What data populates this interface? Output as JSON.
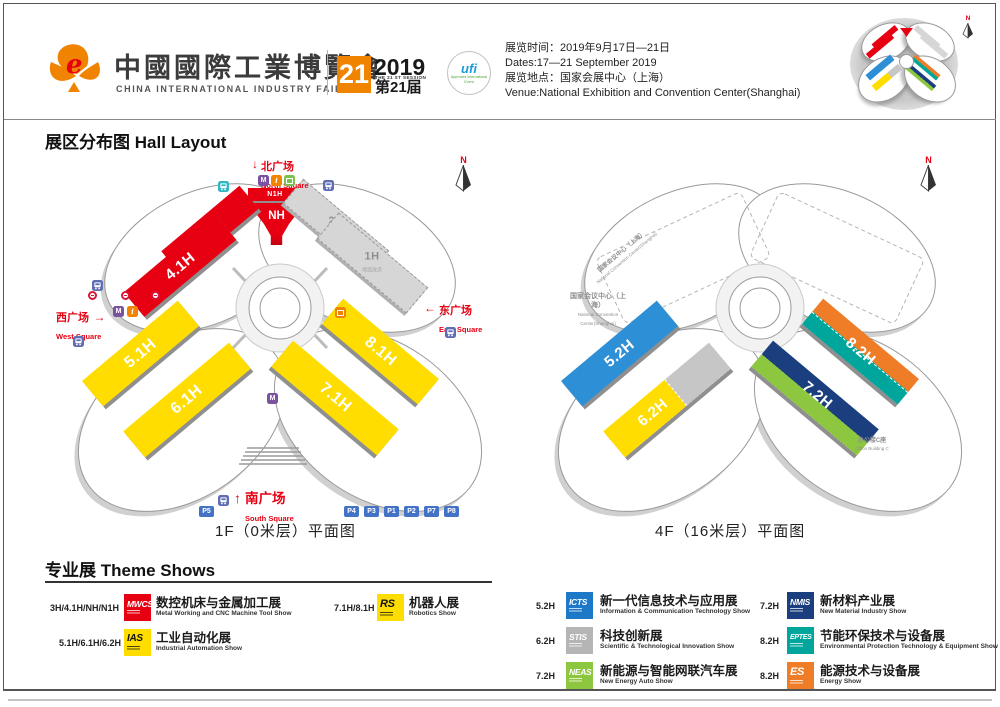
{
  "header": {
    "brand_cn": "中國國際工業博覽會",
    "brand_en": "CHINA INTERNATIONAL INDUSTRY FAIR",
    "badge_number": "21",
    "badge_year": "2019",
    "badge_session_en": "THE 21 ST SESSION",
    "badge_session_cn": "第21届",
    "ufi_name": "ufi",
    "ufi_sub": "Approved International Event",
    "info_lines": [
      "展览时间：2019年9月17日—21日",
      "Dates:17—21 September 2019",
      "展览地点：国家会展中心（上海）",
      "Venue:National Exhibition and Convention Center(Shanghai)"
    ],
    "compass": "N"
  },
  "section": {
    "title_cn": "展区分布图",
    "title_en": "Hall Layout"
  },
  "floor1": {
    "caption": "1F（0米层）平面图",
    "compass": "N",
    "halls": {
      "n1h": "N1H",
      "nh": "NH",
      "h3": "3H",
      "h41": "4.1H",
      "h2": "2H",
      "h2_sub": "场馆改造",
      "h1": "1H",
      "h1_sub": "场馆改造",
      "h51": "5.1H",
      "h61": "6.1H",
      "h71": "7.1H",
      "h81": "8.1H"
    },
    "squares": {
      "north_arrow": "↓",
      "north_cn": "北广场",
      "north_en": "North Square",
      "east_arrow": "←",
      "east_cn": "东广场",
      "east_en": "East Square",
      "west_cn": "西广场",
      "west_arrow": "→",
      "west_en": "West Square",
      "south_arrow": "↑",
      "south_cn": "南广场",
      "south_en": "South Square"
    },
    "parking": [
      "P5",
      "P4",
      "P3",
      "P1",
      "P2",
      "P7",
      "P8"
    ]
  },
  "floor4": {
    "caption": "4F（16米层）平面图",
    "compass": "N",
    "halls": {
      "h52": "5.2H",
      "h62": "6.2H",
      "h72": "7.2H",
      "h82": "8.2H"
    },
    "ncc_cn": "国家会议中心（上海）",
    "ncc_en": "National Convention Center(Shanghai)",
    "office_cn": "办公楼C座",
    "office_en": "Office Building C"
  },
  "theme_shows": {
    "title_cn": "专业展",
    "title_en": "Theme Shows",
    "items": [
      {
        "halls": "3H/4.1H/NH/N1H",
        "logo": "MWCS",
        "color": "#e60012",
        "text_color": "#ffffff",
        "cn": "数控机床与金属加工展",
        "en": "Metal Working and CNC Machine Tool Show"
      },
      {
        "halls": "5.1H/6.1H/6.2H",
        "logo": "IAS",
        "color": "#ffdd00",
        "text_color": "#111111",
        "cn": "工业自动化展",
        "en": "Industrial Automation Show"
      },
      {
        "halls": "7.1H/8.1H",
        "logo": "RS",
        "color": "#ffdd00",
        "text_color": "#111111",
        "cn": "机器人展",
        "en": "Robotics Show"
      },
      {
        "halls": "5.2H",
        "logo": "ICTS",
        "color": "#1e78c8",
        "text_color": "#ffffff",
        "cn": "新一代信息技术与应用展",
        "en": "Information & Communication Technology Show"
      },
      {
        "halls": "6.2H",
        "logo": "STIS",
        "color": "#b5b5b5",
        "text_color": "#ffffff",
        "cn": "科技创新展",
        "en": "Scientific & Technological Innovation Show"
      },
      {
        "halls": "7.2H",
        "logo": "NEAS",
        "color": "#8dc63f",
        "text_color": "#ffffff",
        "cn": "新能源与智能网联汽车展",
        "en": "New Energy Auto Show"
      },
      {
        "halls": "7.2H",
        "logo": "NMIS",
        "color": "#1b3f7e",
        "text_color": "#ffffff",
        "cn": "新材料产业展",
        "en": "New Material Industry Show"
      },
      {
        "halls": "8.2H",
        "logo": "EPTES",
        "color": "#00a59b",
        "text_color": "#ffffff",
        "cn": "节能环保技术与设备展",
        "en": "Environmental Protection Technology & Equipment Show"
      },
      {
        "halls": "8.2H",
        "logo": "ES",
        "color": "#ef7d27",
        "text_color": "#ffffff",
        "cn": "能源技术与设备展",
        "en": "Energy Show"
      }
    ]
  },
  "colors": {
    "red": "#e60012",
    "yellow": "#ffdd00",
    "gray_hall": "#d6d6d6",
    "blue": "#2d8fd5",
    "teal": "#00a59b",
    "orange": "#ef7d27",
    "navy": "#1b3f7e",
    "green": "#8dc63f",
    "silver": "#c6c6c6",
    "badge_orange": "#f08300",
    "metro_purple": "#7a52a0",
    "bus_blue": "#5f6db4",
    "parking_blue": "#4472c4",
    "info_orange": "#f08300",
    "transit_teal": "#2fb6c0",
    "facility_green": "#7bbf4e"
  }
}
